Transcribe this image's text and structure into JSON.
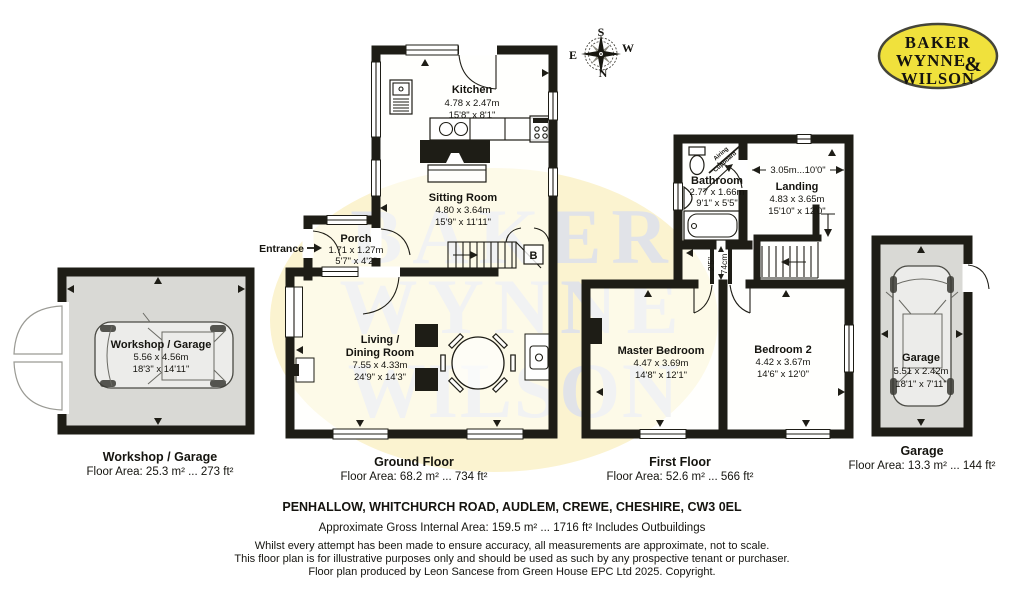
{
  "logo": {
    "line1": "BAKER",
    "line2": "WYNNE",
    "amp": "&",
    "line3": "WILSON"
  },
  "compass": {
    "n": "N",
    "s": "S",
    "e": "E",
    "w": "W"
  },
  "watermark": {
    "line1": "BAKER",
    "line2": "WYNNE",
    "line3": "WILSON"
  },
  "workshop": {
    "label": "Workshop / Garage",
    "dims_m": "5.56 x 4.56m",
    "dims_ft": "18'3\" x 14'11\"",
    "caption": "Workshop / Garage",
    "area": "Floor Area: 25.3 m² ... 273 ft²"
  },
  "ground": {
    "caption": "Ground Floor",
    "area": "Floor Area: 68.2 m² ... 734 ft²",
    "entrance": "Entrance",
    "boiler": "B",
    "kitchen": {
      "name": "Kitchen",
      "m": "4.78 x 2.47m",
      "ft": "15'8\" x 8'1\""
    },
    "sitting": {
      "name": "Sitting Room",
      "m": "4.80 x 3.64m",
      "ft": "15'9\" x 11'11\""
    },
    "porch": {
      "name": "Porch",
      "m": "1.71 x 1.27m",
      "ft": "5'7\" x 4'2\""
    },
    "living": {
      "name1": "Living /",
      "name2": "Dining Room",
      "m": "7.55 x 4.33m",
      "ft": "24'9\" x 14'3\""
    }
  },
  "first": {
    "caption": "First Floor",
    "area": "Floor Area: 52.6 m² ... 566 ft²",
    "bathroom": {
      "name": "Bathroom",
      "m": "2.77 x 1.66m",
      "ft": "9'1\" x 5'5\""
    },
    "landing": {
      "name": "Landing",
      "m": "4.83 x 3.65m",
      "ft": "15'10\" x 12'0\""
    },
    "master": {
      "name": "Master Bedroom",
      "m": "4.47 x 3.69m",
      "ft": "14'8\" x 12'1\""
    },
    "bedroom2": {
      "name": "Bedroom 2",
      "m": "4.42 x 3.67m",
      "ft": "14'6\" x 12'0\""
    },
    "airing1": "Airing",
    "airing2": "Cupboard",
    "landing_dim": "3.05m...10'0\"",
    "passage_ft": "2'5\"",
    "passage_cm": "74cm"
  },
  "garage": {
    "label": "Garage",
    "dims_m": "5.51 x 2.42m",
    "dims_ft": "18'1\" x 7'11\"",
    "caption": "Garage",
    "area": "Floor Area: 13.3 m² ... 144 ft²"
  },
  "footer": {
    "address": "PENHALLOW, WHITCHURCH ROAD, AUDLEM, CREWE, CHESHIRE, CW3 0EL",
    "gross_area": "Approximate Gross Internal Area: 159.5 m² ... 1716 ft² Includes Outbuildings",
    "line1": "Whilst every attempt has been made to ensure accuracy, all measurements are approximate, not to scale.",
    "line2": "This floor plan is for illustrative purposes only and should be used as such by any prospective tenant or purchaser.",
    "line3": "Floor plan produced by Leon Sancese from Green House EPC Ltd 2025. Copyright."
  }
}
